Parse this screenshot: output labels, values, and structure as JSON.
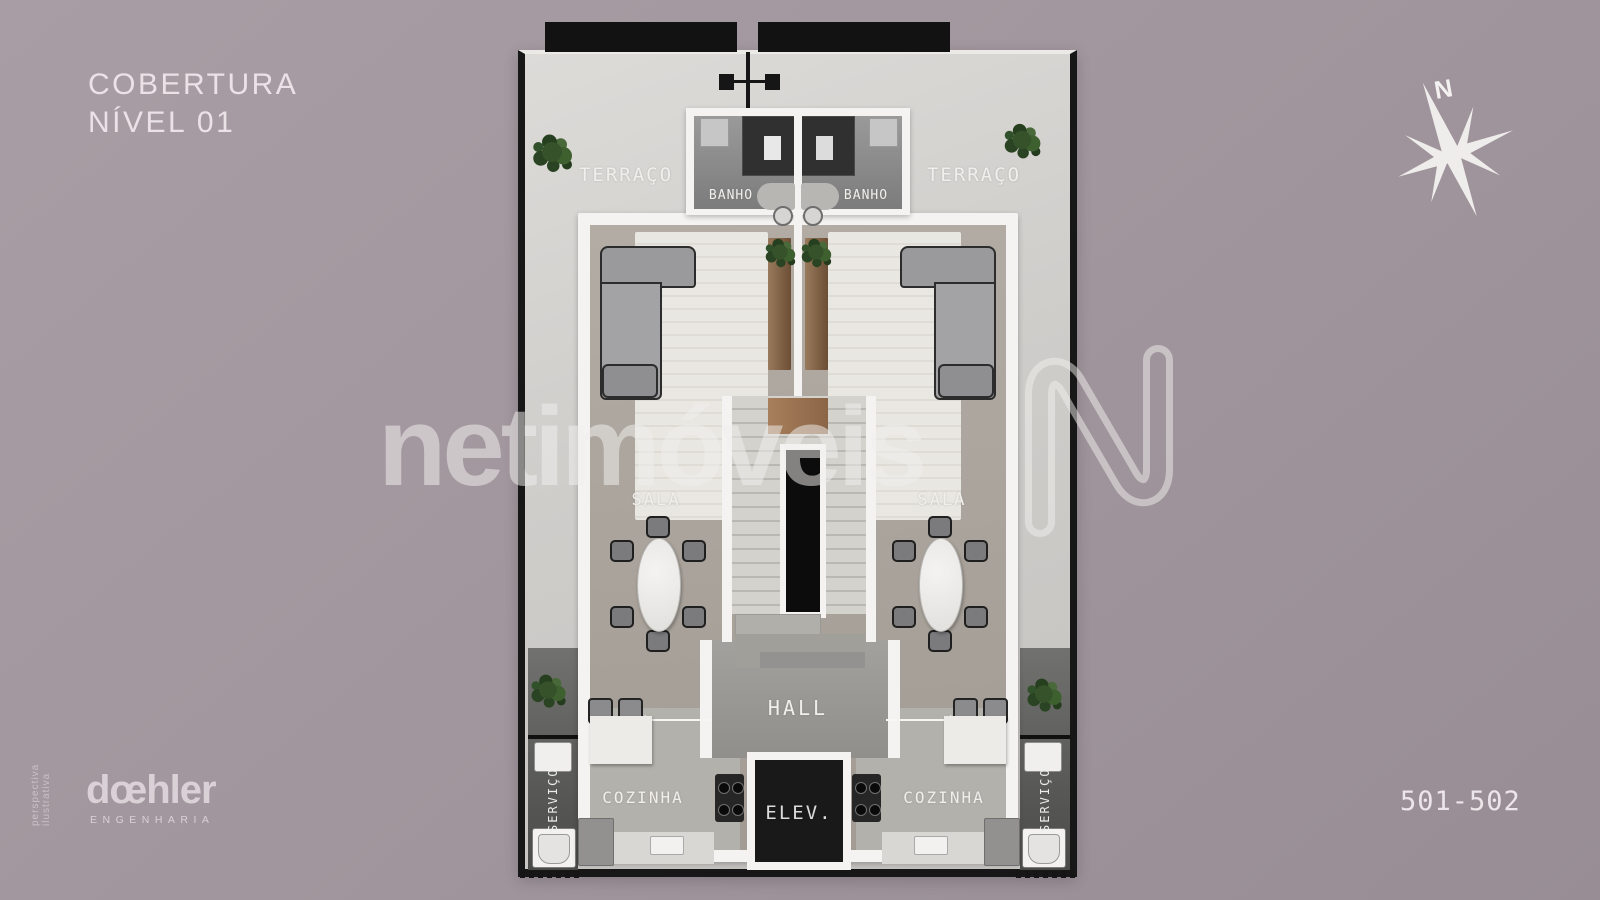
{
  "title": {
    "line1": "COBERTURA",
    "line2": "NÍVEL 01"
  },
  "rooms": {
    "terrace": "TERRAÇO",
    "bath": "BANHO",
    "living": "SALA",
    "hall": "HALL",
    "elevator": "ELEV.",
    "kitchen": "COZINHA",
    "service": "SERVIÇO"
  },
  "plate": {
    "units": "501-502"
  },
  "compass": {
    "north": "N"
  },
  "watermark": {
    "brand": "netimóveis",
    "logo": "N"
  },
  "credits": {
    "engineering_logo": "dœhler",
    "engineering_sub": "ENGENHARIA",
    "disclaimer": "perspectiva ilustrativa"
  },
  "colors": {
    "background": "#a0959c",
    "wall_black": "#171717",
    "wall_white": "#f5f3f1",
    "terrace_floor": "#d3d1ce",
    "unit_floor": "#a8a29a",
    "bath_floor": "#8f8f8f",
    "service_floor": "#525250",
    "elevator_shaft": "#191919",
    "stair_void": "#0c0c0c",
    "rug": "#e9e7e1",
    "wood": "#8a6546",
    "plant": "#355229",
    "sofa": "#9a999b",
    "label_text": "#f1efec",
    "watermark": "rgba(242,240,238,0.52)"
  }
}
